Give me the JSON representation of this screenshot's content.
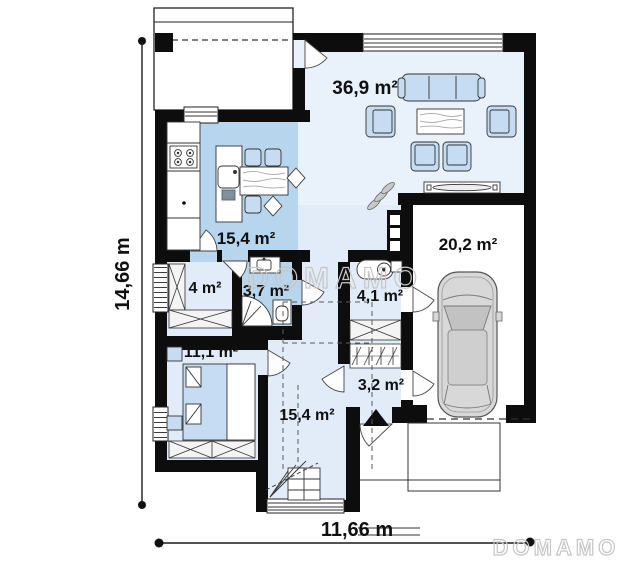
{
  "plan": {
    "brand": "DOMAMO",
    "watermark_center": "DOMAMO",
    "watermark_corner": "DOMAMO",
    "dimensions": {
      "width": "11,66 m",
      "height": "14,66 m"
    },
    "rooms": [
      {
        "name": "living-room",
        "area": "36,9 m²"
      },
      {
        "name": "kitchen",
        "area": "15,4 m²"
      },
      {
        "name": "garage",
        "area": "20,2 m²"
      },
      {
        "name": "wardrobe",
        "area": "4 m²"
      },
      {
        "name": "bathroom",
        "area": "3,7 m²"
      },
      {
        "name": "utility",
        "area": "4,1 m²"
      },
      {
        "name": "bedroom",
        "area": "11,1 m²"
      },
      {
        "name": "vestibule",
        "area": "3,2 m²"
      },
      {
        "name": "hall",
        "area": "15,4 m²"
      }
    ],
    "colors": {
      "wall": "#0d0d0d",
      "floor_light": "#e2ecf8",
      "floor_living": "#e9f1fb",
      "floor_medium": "#b7d5ec",
      "furniture_blue": "#c5dcf2",
      "garage_floor": "#ffffff"
    }
  }
}
